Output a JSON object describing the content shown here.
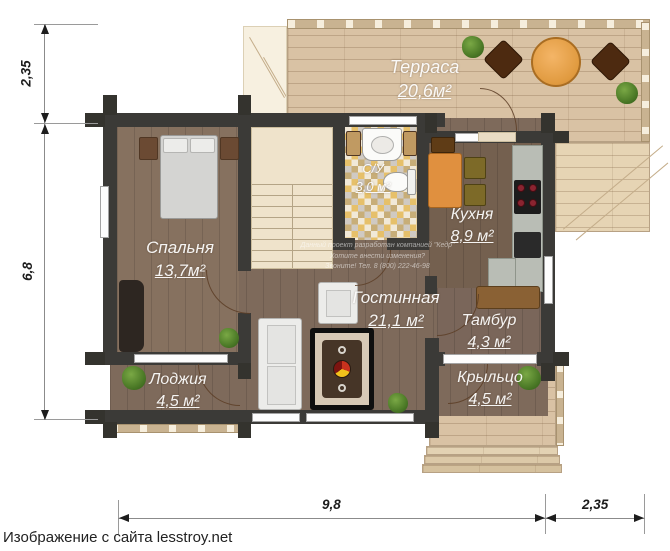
{
  "caption": "Изображение с сайта lesstroy.net",
  "watermark": {
    "line1": "Данный проект разработан компанией \"Кедр\"",
    "line2": "Хотите внести изменения?",
    "line3": "Звоните! Тел. 8 (800) 222-46-98"
  },
  "dimensions": {
    "left_top": "2,35",
    "left_main": "6,8",
    "bottom_main": "9,8",
    "bottom_right": "2,35"
  },
  "rooms": {
    "terrace": {
      "name": "Терраса",
      "area": "20,6м²"
    },
    "bedroom": {
      "name": "Спальня",
      "area": "13,7м²"
    },
    "bathroom": {
      "name": "С/У",
      "area": "3,0 м²"
    },
    "kitchen": {
      "name": "Кухня",
      "area": "8,9 м²"
    },
    "living": {
      "name": "Гостинная",
      "area": "21,1 м²"
    },
    "tambur": {
      "name": "Тамбур",
      "area": "4,3 м²"
    },
    "loggia": {
      "name": "Лоджия",
      "area": "4,5 м²"
    },
    "porch": {
      "name": "Крыльцо",
      "area": "4,5 м²"
    }
  },
  "colors": {
    "wall": "#3b3a37",
    "deck": "#d9c2a4",
    "floor": "#7e6a5b",
    "tile_yellow": "#e6c06a",
    "accent_orange": "#e0903f"
  }
}
